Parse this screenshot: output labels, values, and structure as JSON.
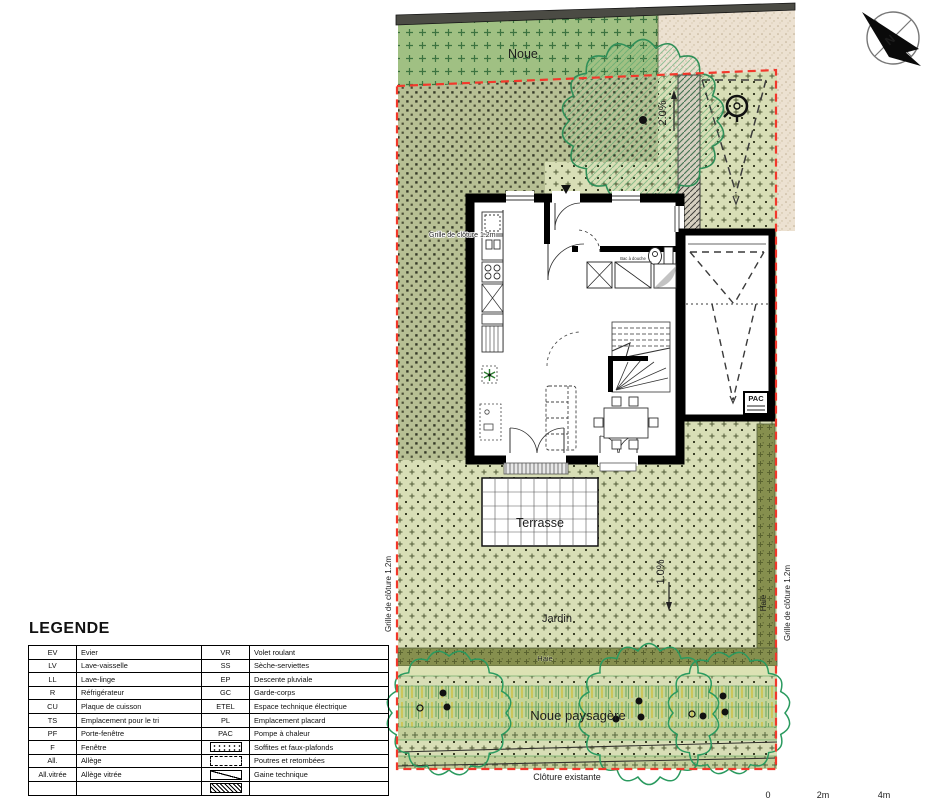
{
  "plan": {
    "labels": {
      "noue": "Noue",
      "slope_top": "2.0%",
      "slope_bottom": "1.0%",
      "grille_top": "Grille de clôture 1.2m",
      "grille_left": "Grille de clôture 1.2m",
      "grille_right": "Grille de clôture 1.2m",
      "terrasse": "Terrasse",
      "jardin": "Jardin",
      "haie_band": "Haie",
      "haie_right": "Haie",
      "noue_paysagere": "Noue paysagère",
      "cloture": "Clôture existante",
      "pac": "PAC",
      "shower": "Bac à douche",
      "north": "N"
    },
    "scale": {
      "s0": "0",
      "s1": "2m",
      "s2": "4m"
    },
    "icons": [
      "north-arrow-icon",
      "utility-marker-icon"
    ]
  },
  "legend": {
    "title": "LEGENDE",
    "rows": [
      {
        "k1": "EV",
        "v1": "Evier",
        "k2": "VR",
        "v2": "Volet roulant"
      },
      {
        "k1": "LV",
        "v1": "Lave-vaisselle",
        "k2": "SS",
        "v2": "Sèche-serviettes"
      },
      {
        "k1": "LL",
        "v1": "Lave-linge",
        "k2": "EP",
        "v2": "Descente pluviale"
      },
      {
        "k1": "R",
        "v1": "Réfrigérateur",
        "k2": "GC",
        "v2": "Garde-corps"
      },
      {
        "k1": "CU",
        "v1": "Plaque de cuisson",
        "k2": "ETEL",
        "v2": "Espace technique électrique"
      },
      {
        "k1": "TS",
        "v1": "Emplacement pour le tri",
        "k2": "PL",
        "v2": "Emplacement placard"
      },
      {
        "k1": "PF",
        "v1": "Porte-fenêtre",
        "k2": "PAC",
        "v2": "Pompe à chaleur"
      },
      {
        "k1": "F",
        "v1": "Fenêtre",
        "icon2": "soffits-pattern",
        "v2": "Soffites et faux-plafonds"
      },
      {
        "k1": "All.",
        "v1": "Allège",
        "icon2": "beam-dashed",
        "v2": "Poutres et retombées"
      },
      {
        "k1": "All.vitrée",
        "v1": "Allège vitrée",
        "icon2": "duct-diagonal",
        "v2": "Gaine technique"
      },
      {
        "k1": "",
        "v1": "",
        "icon2": "hatched",
        "v2": ""
      }
    ]
  },
  "colors": {
    "boundary_red": "#f2382b",
    "noue_green": "#a0c083",
    "garden_light": "#d8deb6",
    "garden_dense": "#b7bf94",
    "beige": "#ece1d1",
    "haie_olive": "#868f4e",
    "tree_green": "#2e9e63",
    "wall_black": "#000000",
    "band_gray": "#4b4b44"
  }
}
